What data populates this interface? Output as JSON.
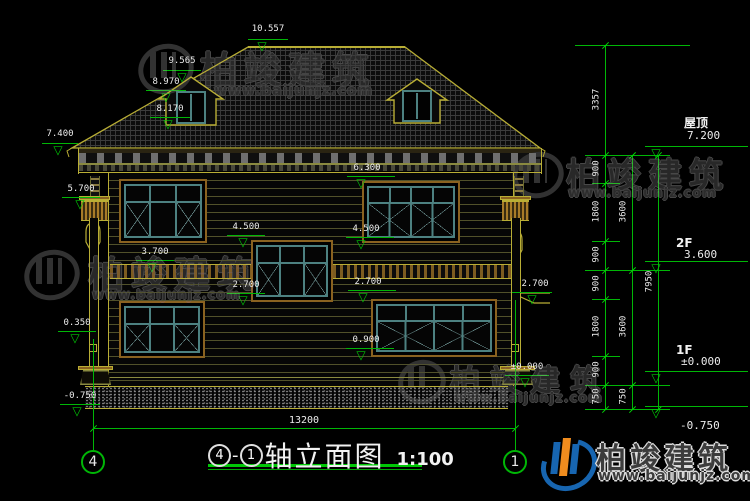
{
  "colors": {
    "background": "#000000",
    "dimension_green": "#00b606",
    "outline_yellow": "#b9ae35",
    "frame_brown": "#8a6220",
    "window_teal": "#4d8181",
    "text_white": "#ececec",
    "logo_blue": "#1765b0",
    "logo_orange": "#f08c1e"
  },
  "annotations": {
    "ridge": "10.557",
    "dormer_peak": "9.565",
    "dormer_eave": "8.970",
    "dormer_sill": "8.170",
    "eave_left": "7.400",
    "capital_left": "5.700",
    "head_2f": "6.300",
    "sill_2f": "4.500",
    "stair_head": "4.500",
    "frieze": "3.700",
    "stair_sill": "2.700",
    "head_1f": "2.700",
    "canopy": "2.700",
    "sill_1f": "0.900",
    "pedestal": "0.350",
    "ground": "±0.000",
    "base_left": "-0.750"
  },
  "dim_chains": {
    "inner": [
      "3357",
      "900",
      "1800",
      "900",
      "900",
      "1800",
      "900",
      "750"
    ],
    "middle": [
      "3600",
      "3600",
      "750"
    ],
    "total": "7950",
    "width": "13200"
  },
  "floor_levels": [
    {
      "label": "屋顶",
      "value": "7.200"
    },
    {
      "label": "2F",
      "value": "3.600"
    },
    {
      "label": "1F",
      "value": "±0.000"
    },
    {
      "label": "",
      "value": "-0.750"
    }
  ],
  "axes": {
    "left": "4",
    "right": "1"
  },
  "title": {
    "axis_left": "4",
    "separator": "-",
    "axis_right": "1",
    "name": "轴立面图",
    "scale": "1:100"
  },
  "watermark": {
    "brand": "柏竣建筑",
    "url": "www.baijunjz.com"
  }
}
